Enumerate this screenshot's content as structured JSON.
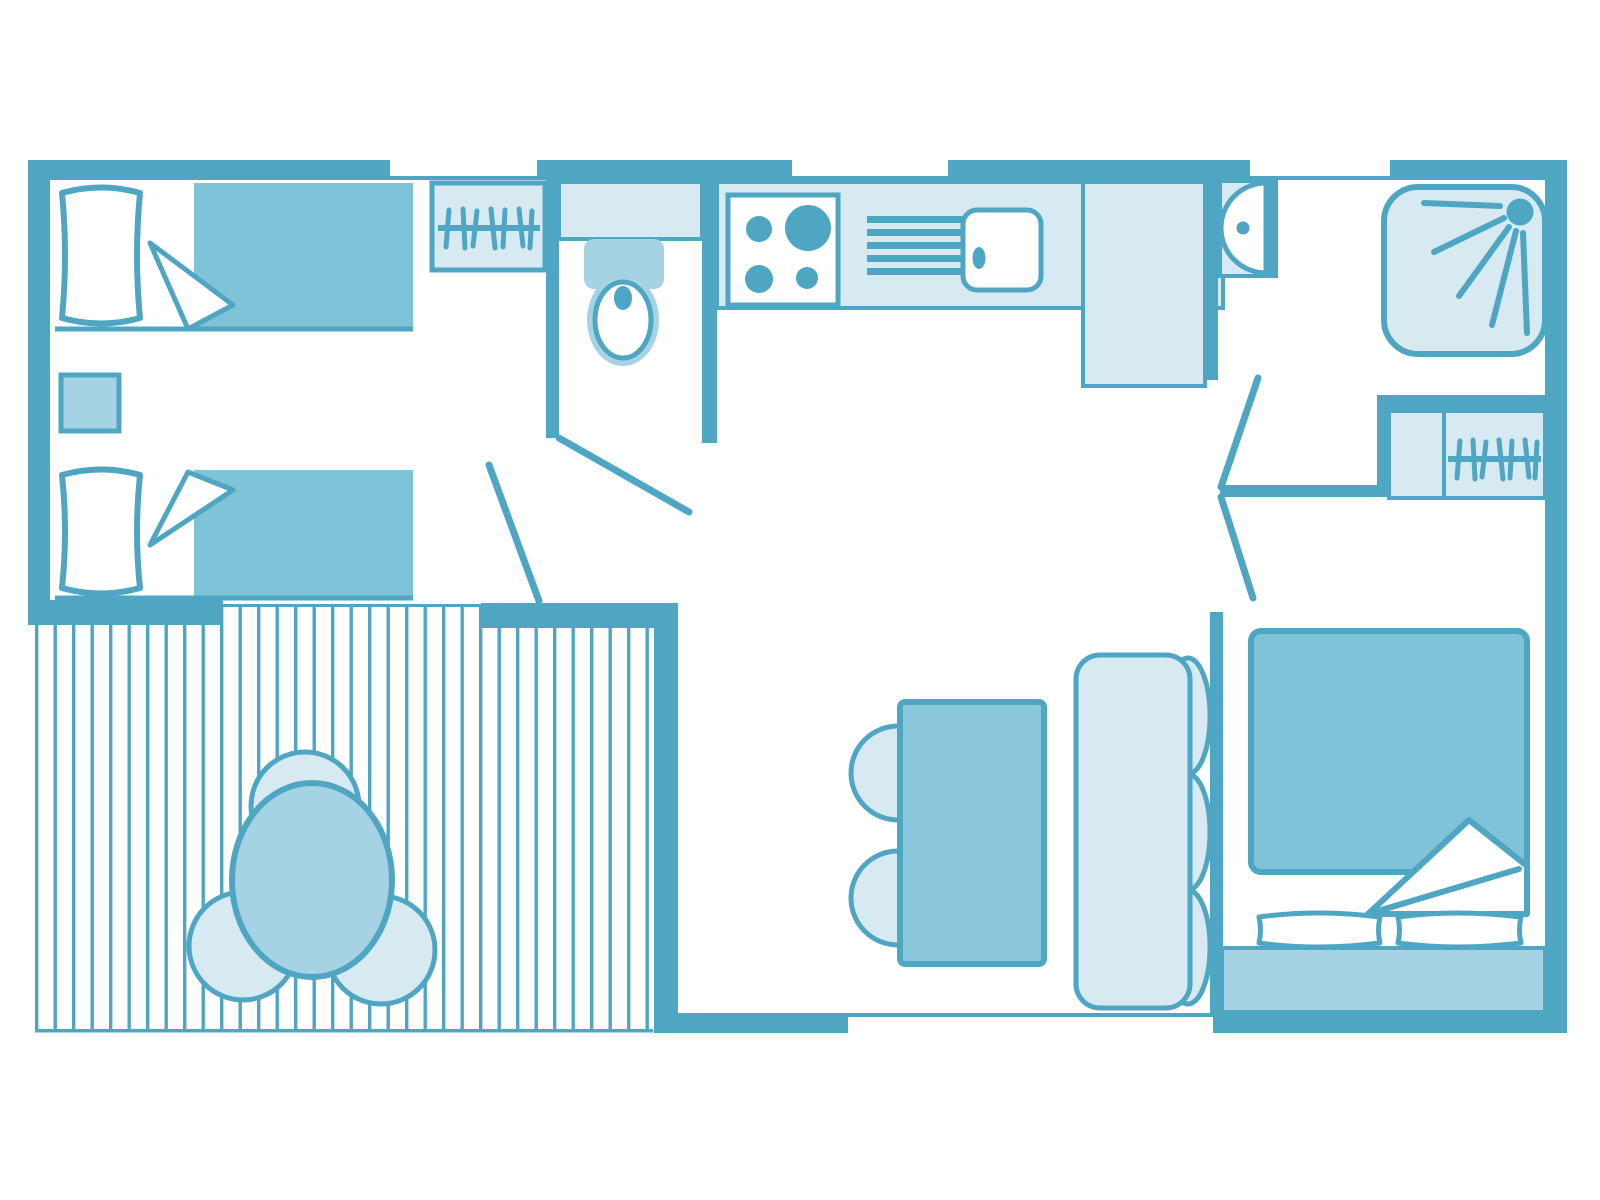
{
  "title": "Mobile-home floor plan",
  "colors": {
    "wall": "#4FA6C3",
    "medium": "#7EC3D8",
    "midlight": "#A6D3E3",
    "light": "#D7EAF2",
    "table": "#8BC7DA",
    "background": "#FFFFFF"
  },
  "rooms": [
    {
      "id": "twin-bedroom",
      "furniture": [
        "single-bed",
        "single-bed",
        "nightstand",
        "wardrobe-hangers"
      ]
    },
    {
      "id": "bathroom",
      "furniture": [
        "vanity-counter",
        "toilet"
      ]
    },
    {
      "id": "kitchen",
      "furniture": [
        "worktop",
        "hob-4-burners",
        "dish-rack",
        "sink",
        "tall-cabinet"
      ]
    },
    {
      "id": "shower-room",
      "furniture": [
        "shower-tray",
        "washbasin",
        "wardrobe-hangers"
      ]
    },
    {
      "id": "living-dining",
      "furniture": [
        "dining-table",
        "dining-chair",
        "dining-chair",
        "bench-seat"
      ]
    },
    {
      "id": "master-bedroom",
      "furniture": [
        "double-bed",
        "pillow",
        "pillow",
        "headboard"
      ]
    },
    {
      "id": "terrace",
      "furniture": [
        "decking",
        "round-table",
        "terrace-chair",
        "terrace-chair",
        "terrace-chair"
      ]
    }
  ],
  "icons": [
    "hanger-rail-icon",
    "hob-icon",
    "dish-rack-icon",
    "sink-icon",
    "toilet-icon",
    "washbasin-icon",
    "shower-spray-icon"
  ]
}
